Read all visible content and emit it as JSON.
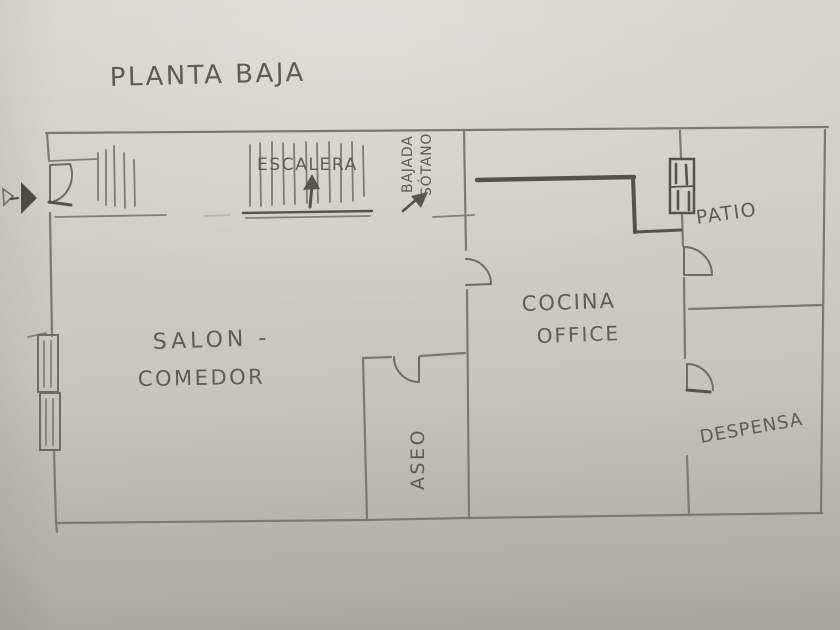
{
  "title": "PLANTA BAJA",
  "colors": {
    "paper": "#cfccc6",
    "pencil": "#7c7873",
    "pencil_dark": "#55514c",
    "handwriting": "#5f5b56"
  },
  "rooms": {
    "escalera": {
      "label": "ESCALERA"
    },
    "salon_comedor": {
      "line1": "SALON -",
      "line2": "COMEDOR"
    },
    "cocina_office": {
      "line1": "COCINA",
      "line2": "OFFICE"
    },
    "aseo": {
      "label": "ASEO"
    },
    "patio": {
      "label": "PATIO"
    },
    "despensa": {
      "label": "DESPENSA"
    }
  },
  "annotations": {
    "bajada_sotano": {
      "line1": "BAJADA",
      "line2": "SÓTANO"
    }
  }
}
